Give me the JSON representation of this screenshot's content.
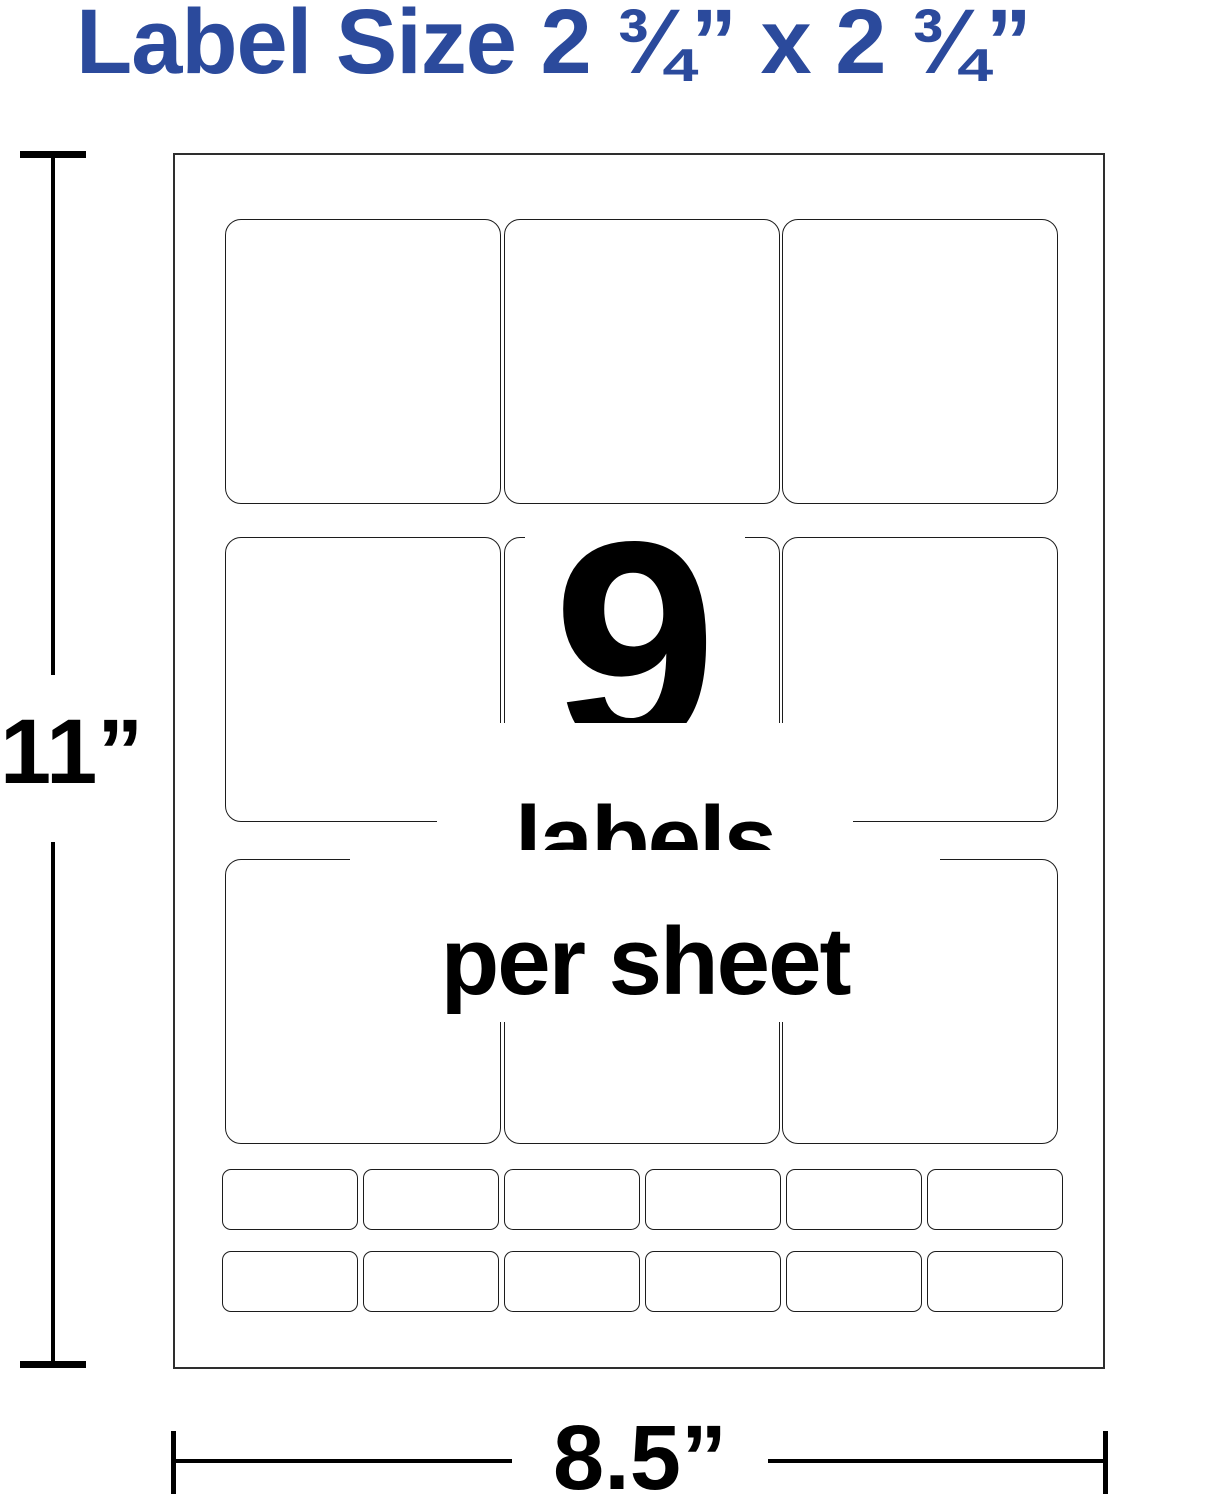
{
  "title": {
    "text": "Label Size 2 ¾” x 2 ¾”",
    "color": "#2B4A9C"
  },
  "sheet": {
    "count_number": "9",
    "labels_word": "labels",
    "per_sheet_words": "per sheet",
    "grid": {
      "rows": 3,
      "cols": 3
    },
    "small_labels": {
      "rows": 2,
      "cols": 6
    }
  },
  "dimensions": {
    "height_label": "11”",
    "width_label": "8.5”"
  },
  "colors": {
    "accent_blue": "#2B4A9C",
    "line_black": "#000000",
    "label_border": "#1c1c1c"
  }
}
